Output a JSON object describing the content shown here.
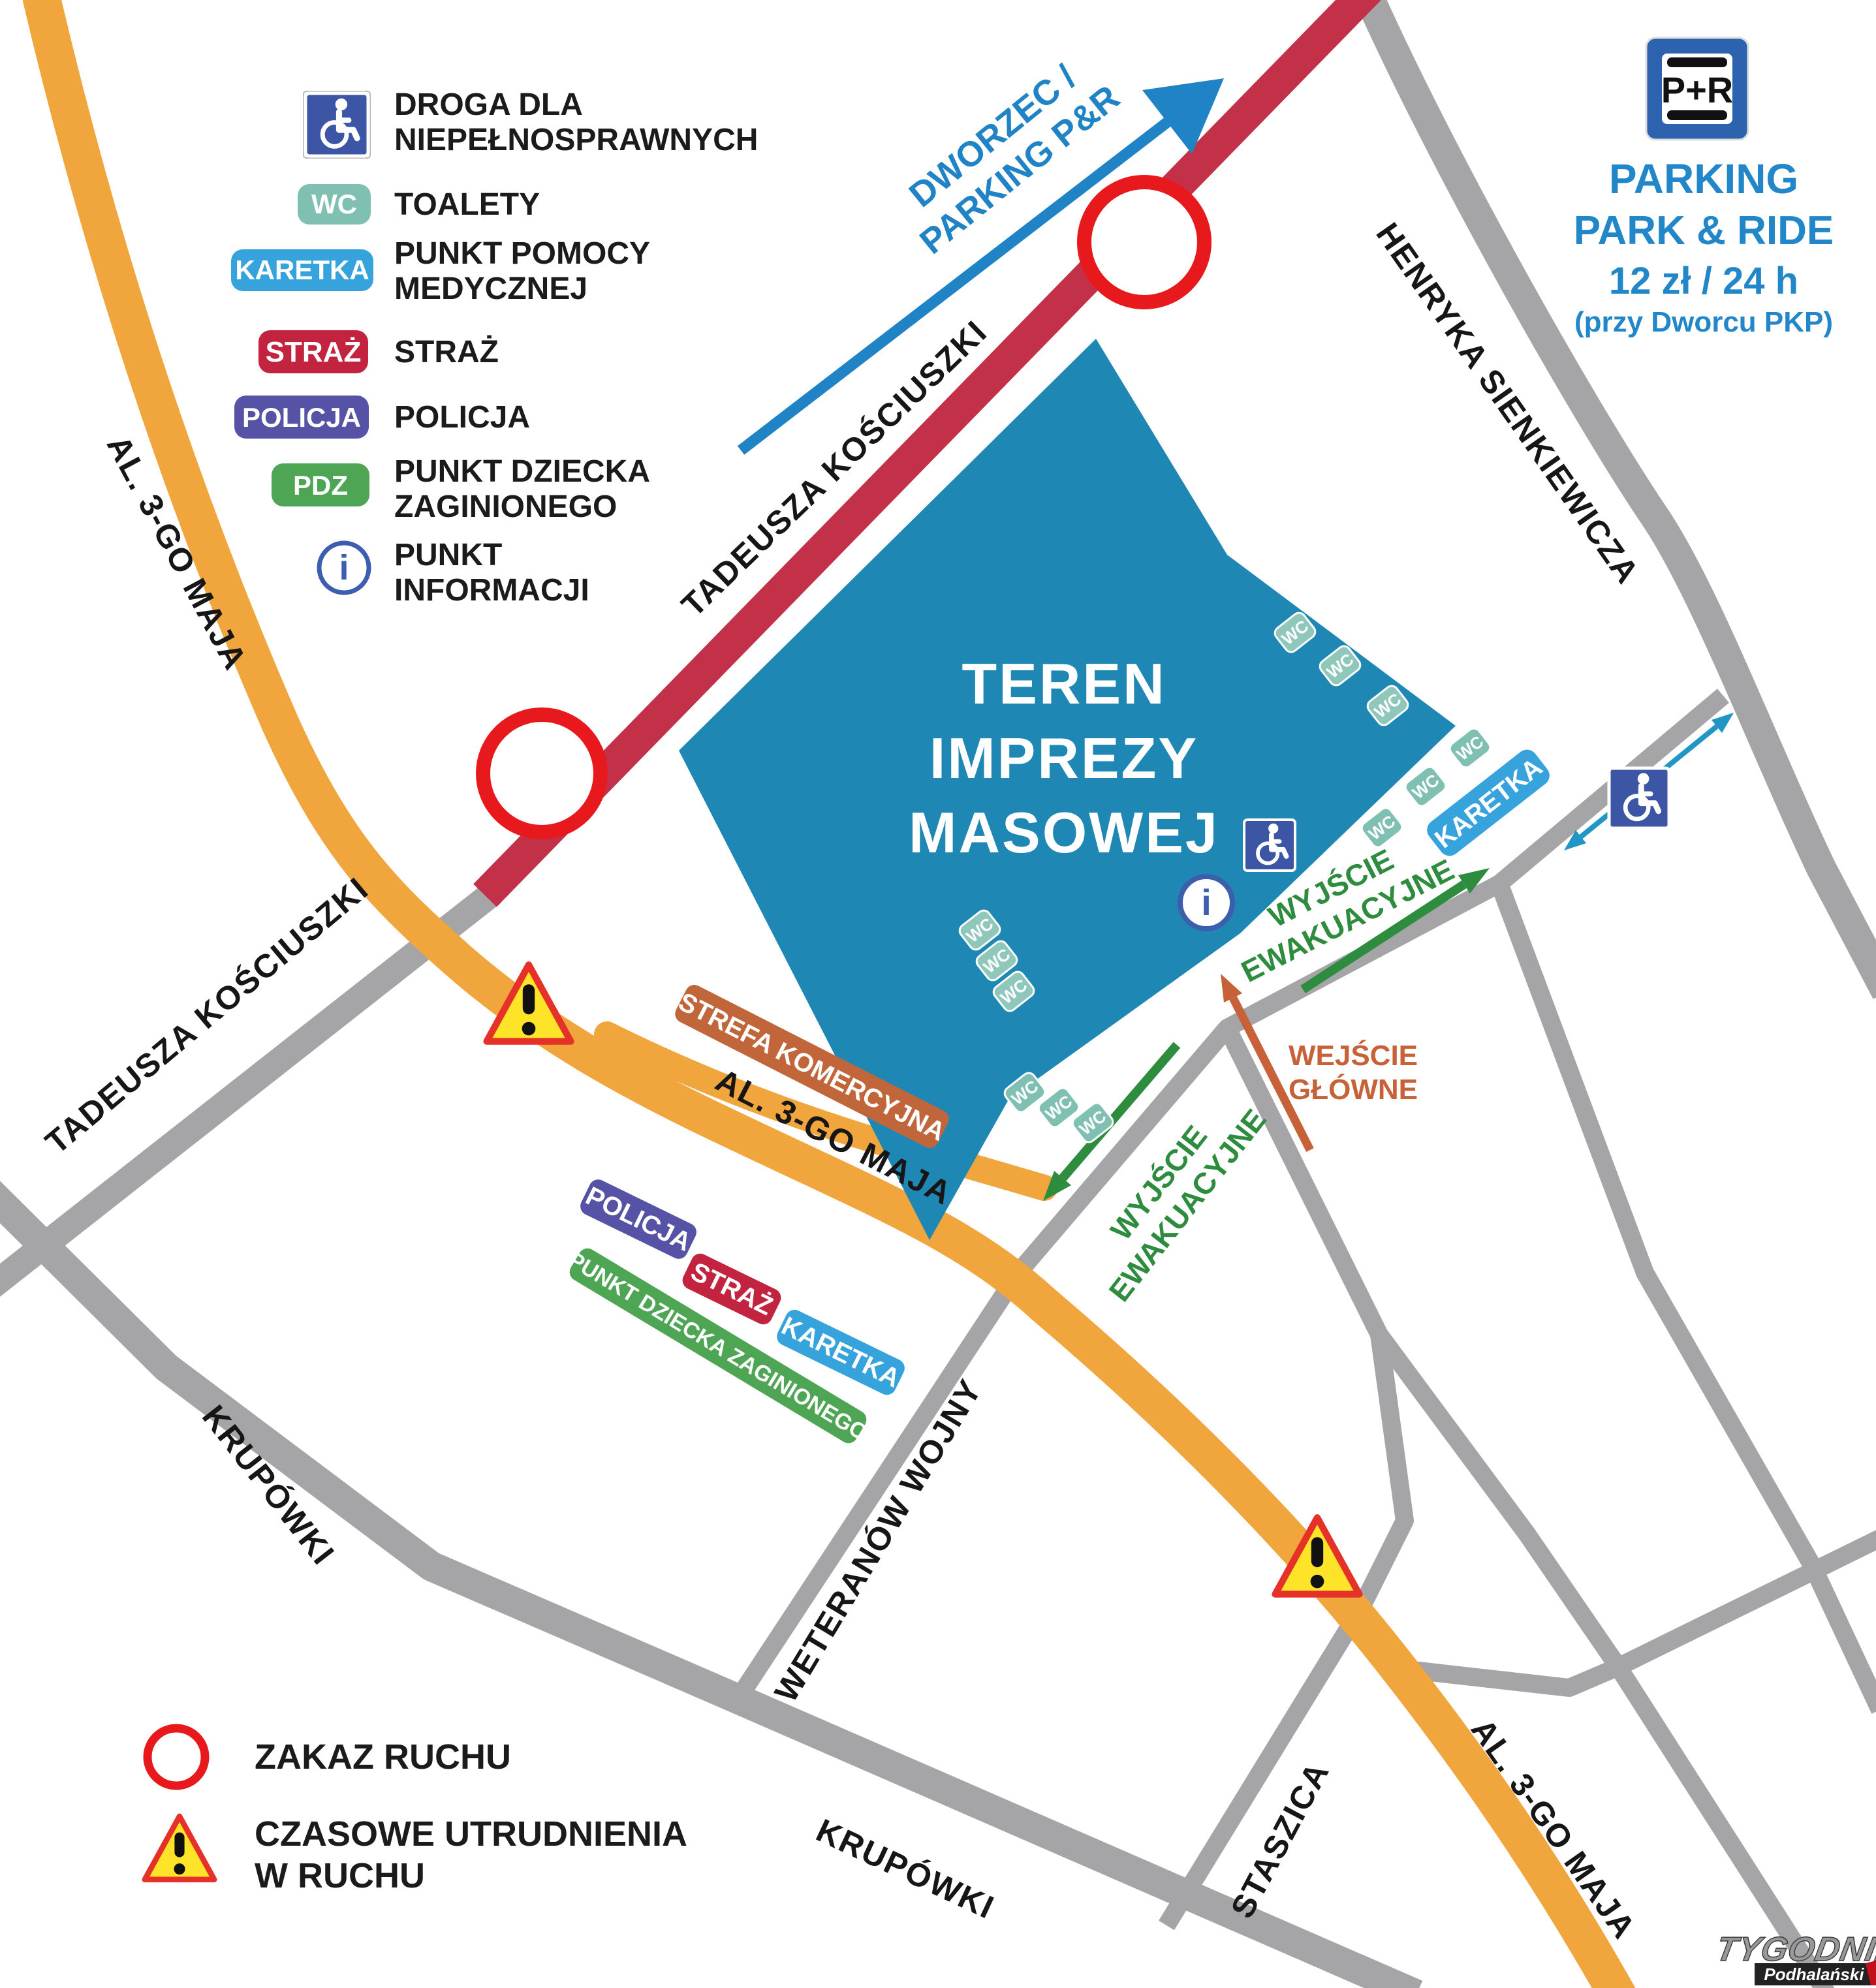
{
  "colors": {
    "event_area": "#1f87b4",
    "road_closed_red": "#c23148",
    "road_orange": "#f0a53d",
    "road_gray": "#a5a5a7",
    "wc_teal": "#7fc0b2",
    "wc_teal_light": "#8fc8bb",
    "medical_blue": "#36a3dd",
    "police_purple": "#5652a5",
    "fire_red": "#c22440",
    "child_green": "#4ea654",
    "commercial_brown": "#c0663a",
    "exit_green": "#2e8c3e",
    "entrance_orange": "#c66138",
    "direction_blue": "#1f83c5",
    "sign_blue": "#3c55a5",
    "parking_blue": "#2187c8",
    "alert_red": "#e8191c",
    "warning_yellow": "#fde428",
    "warning_border": "#e53127"
  },
  "legend": {
    "items": [
      {
        "icon": "wheelchair-sign",
        "line1": "DROGA DLA",
        "line2": "NIEPEŁNOSPRAWNYCH"
      },
      {
        "badge": "WC",
        "line1": "TOALETY"
      },
      {
        "badge": "KARETKA",
        "line1": "PUNKT POMOCY",
        "line2": "MEDYCZNEJ"
      },
      {
        "badge": "STRAŻ",
        "line1": "STRAŻ"
      },
      {
        "badge": "POLICJA",
        "line1": "POLICJA"
      },
      {
        "badge": "PDZ",
        "line1": "PUNKT DZIECKA",
        "line2": "ZAGINIONEGO"
      },
      {
        "icon": "info-point",
        "line1": "PUNKT",
        "line2": "INFORMACJI"
      }
    ],
    "zakaz_ruchu": "ZAKAZ RUCHU",
    "utrudnienia_line1": "CZASOWE UTRUDNIENIA",
    "utrudnienia_line2": "W RUCHU"
  },
  "parking": {
    "sign": "P+R",
    "line1": "PARKING",
    "line2": "PARK & RIDE",
    "line3": "12 zł / 24 h",
    "line4": "(przy Dworcu PKP)"
  },
  "event_area": {
    "line1": "TEREN",
    "line2": "IMPREZY",
    "line3": "MASOWEJ"
  },
  "directions": {
    "dworzec_line1": "DWORZEC /",
    "dworzec_line2": "PARKING P&R",
    "wyjscie_line1": "WYJŚCIE",
    "wyjscie_line2": "EWAKUACYJNE",
    "wejscie_line1": "WEJŚCIE",
    "wejscie_line2": "GŁÓWNE"
  },
  "streets": {
    "kosciuszki": "TADEUSZA KOŚCIUSZKI",
    "al_3go_maja": "AL. 3-GO MAJA",
    "sienkiewicza": "HENRYKA SIENKIEWICZA",
    "krupowki": "KRUPÓWKI",
    "weteranow_wojny": "WETERANÓW WOJNY",
    "staszica": "STASZICA"
  },
  "markers": {
    "wc": "WC",
    "karetka": "KARETKA",
    "policja": "POLICJA",
    "straz": "STRAŻ",
    "punkt_dziecka": "PUNKT DZIECKA ZAGINIONEGO",
    "strefa_komercyjna": "STREFA KOMERCYJNA",
    "info_i": "i"
  },
  "watermark": {
    "line1": "TYGODNIK",
    "line2": "Podhalański"
  }
}
